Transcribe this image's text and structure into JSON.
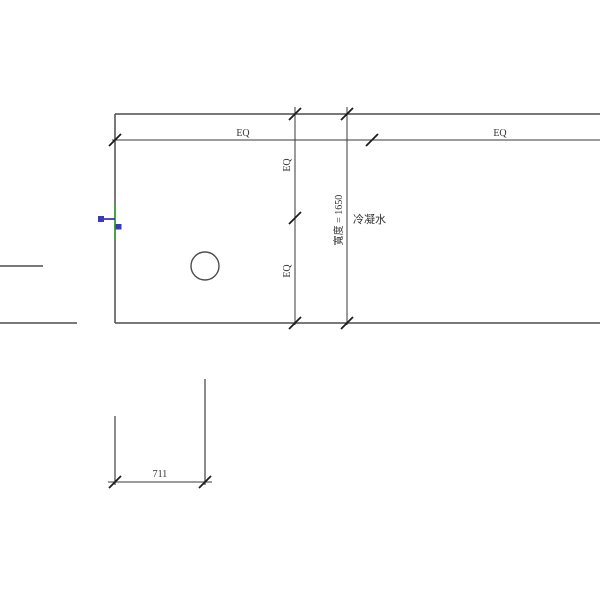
{
  "colors": {
    "background": "#ffffff",
    "model_line": "#4d4d4d",
    "dimension_line": "#3a3a3a",
    "tick": "#1c1c1c",
    "text": "#333333",
    "connector_blue": "#3a3ab8",
    "connector_green": "#3fa43f"
  },
  "dimensions": {
    "top_eq": {
      "left_label": "EQ",
      "right_label": "EQ"
    },
    "side_eq": {
      "upper_label": "EQ",
      "lower_label": "EQ"
    },
    "width": {
      "label": "寬度 = 1650"
    },
    "bottom": {
      "label": "711"
    }
  },
  "labels": {
    "condensate": "冷凝水"
  }
}
